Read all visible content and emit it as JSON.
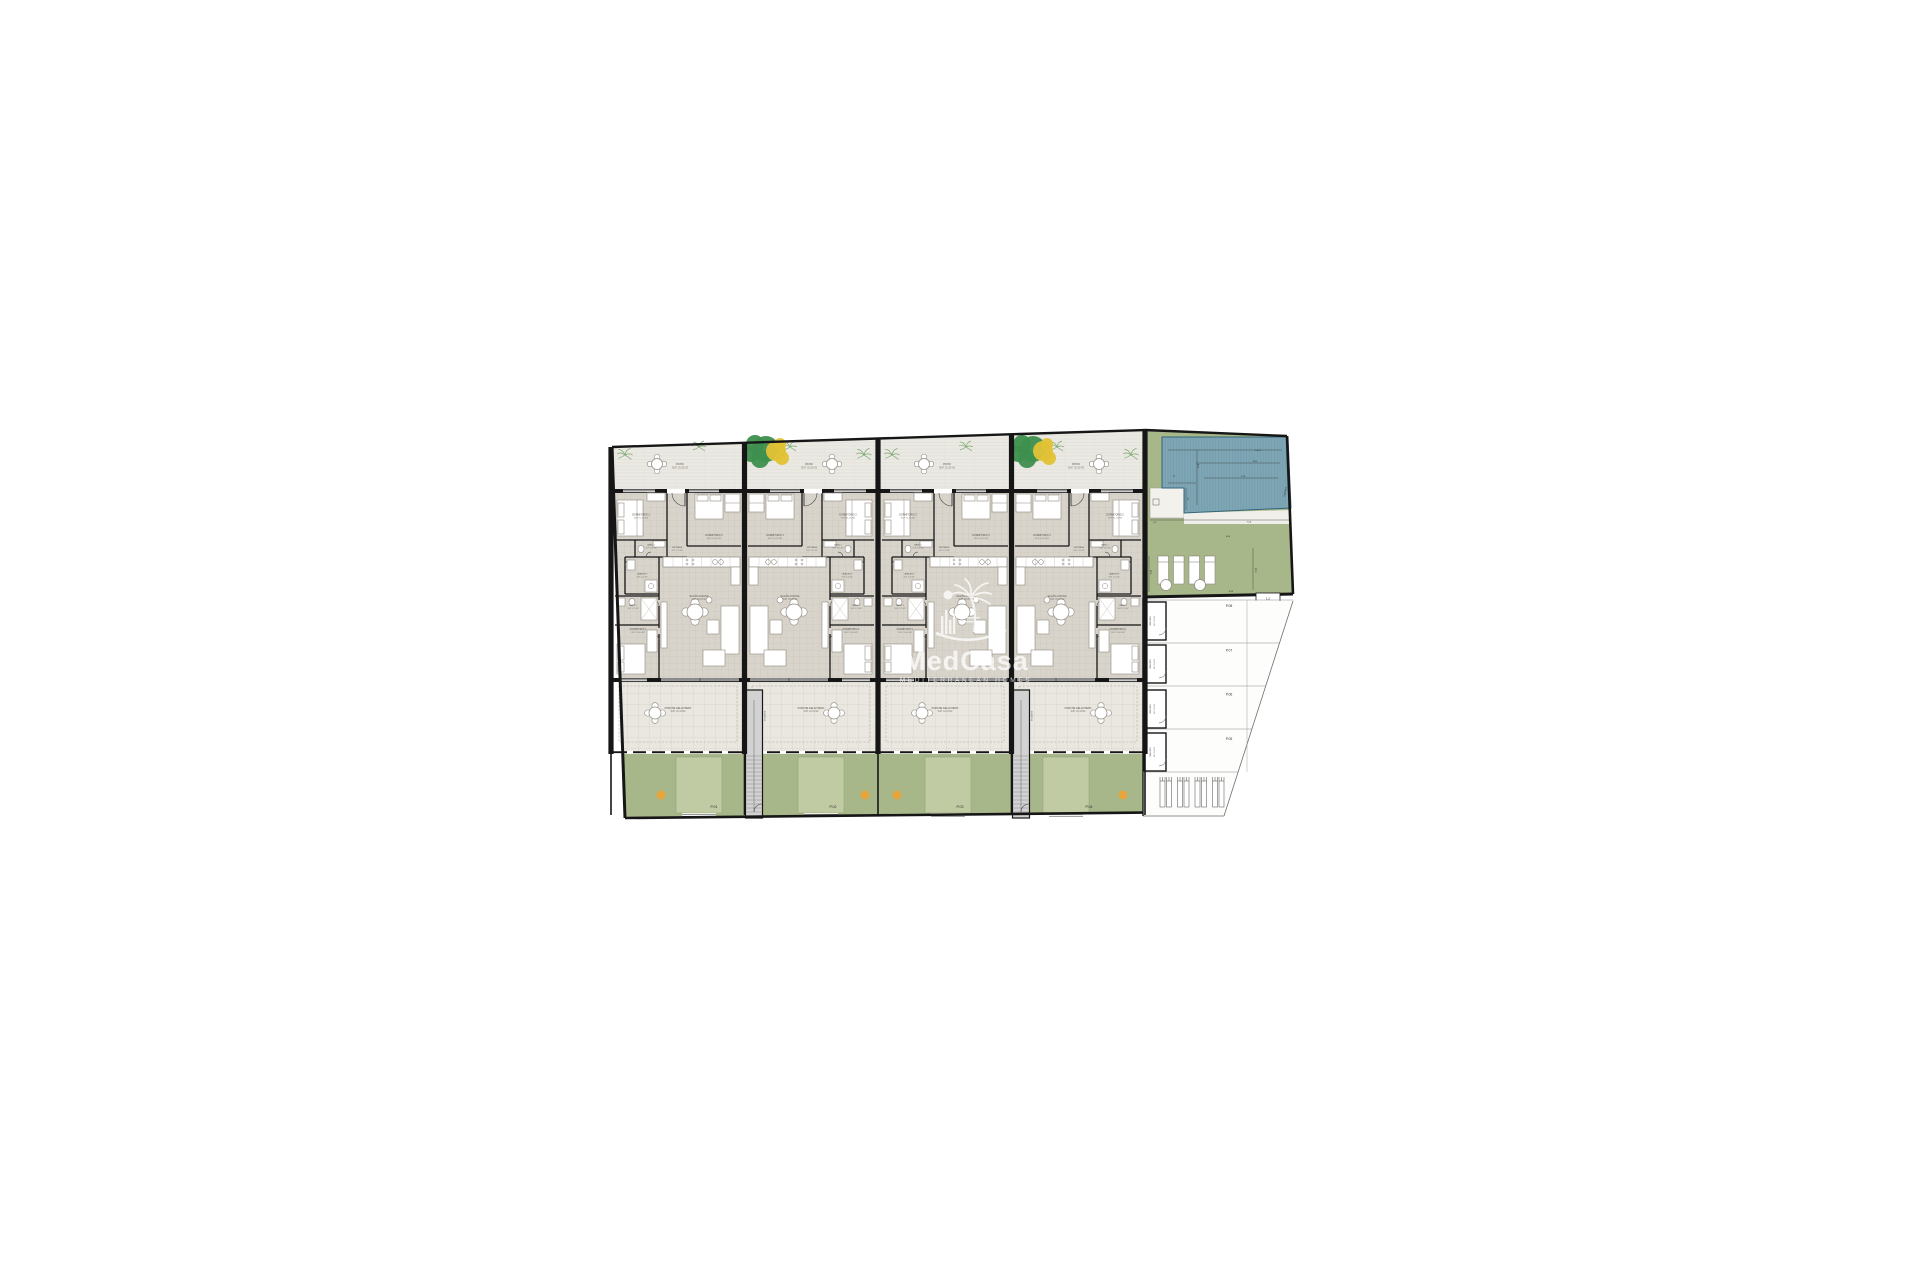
{
  "watermark": {
    "brand": "MedCasa",
    "tagline": "MEDITERRANEAN HOMES",
    "logo": "palm-sun-skyline-icon"
  },
  "rooms": {
    "patio": {
      "name": "PATIO",
      "area": "SUP. 25,20 M2"
    },
    "dorm2": {
      "name": "DORMITORIO 2",
      "area": "SUP. 11,05 M2"
    },
    "dorm3": {
      "name": "DORMITORIO 3",
      "area": "SUP. 10,26 M2"
    },
    "bano2": {
      "name": "BAÑO 2",
      "area": "SUP. 3,60 M2"
    },
    "entrada": {
      "name": "ENTRADA",
      "area": "SUP. 1,15 M2"
    },
    "lavadero": {
      "name": "LAVADERO",
      "area": "SUP. 3,16 M2"
    },
    "bano1": {
      "name": "BAÑO 1",
      "area": "SUP. 3,75 M2"
    },
    "dorm1": {
      "name": "DORMITORIO 1",
      "area": "SUP. 11,60 M2"
    },
    "salon": {
      "name": "SALÓN-COCINA",
      "area": "SUP. 30,20 M2"
    },
    "porche": {
      "name": "PORCHE DELANTERO",
      "area": "SUP. 43,44 M2"
    }
  },
  "units": [
    {
      "parking_label": "P.01",
      "mirrored": false
    },
    {
      "parking_label": "P.02",
      "mirrored": true
    },
    {
      "parking_label": "P.03",
      "mirrored": false
    },
    {
      "parking_label": "P.04",
      "mirrored": true
    }
  ],
  "stairs": {
    "label": "ESCALERA"
  },
  "pool": {
    "label": "PISCINA",
    "dimensions": {
      "top_width": "10,67",
      "upper_width": "8,85",
      "inner_width": "7,29",
      "depth_left": "2,98",
      "ledge": "1,1",
      "step": "1,6",
      "gap": "0,1",
      "deck_width": "7,06",
      "lawn_width": "9,60",
      "lawn_height_left": "4,44",
      "lawn_height_right": "4,41",
      "bottom_offset": "0,95",
      "gate_width": "1,2"
    }
  },
  "parking": {
    "spaces": [
      "P.08",
      "P.07",
      "P.06",
      "P.05"
    ],
    "storage": {
      "name": "TRASTERO",
      "area": "SUP. 2,65 M2"
    },
    "bike_racks": 4
  },
  "colors": {
    "wall": "#161616",
    "lawn_green": "#a7b789",
    "pad_green": "#c0cba4",
    "pool_blue": "#7ea6b4",
    "pool_edge": "#35657a",
    "accent_orange": "#e6a43d",
    "tree_green": "#3e8f4e",
    "tree_yellow": "#e2c235",
    "palm_green": "#7aa96f",
    "label_gray": "#57534b"
  }
}
